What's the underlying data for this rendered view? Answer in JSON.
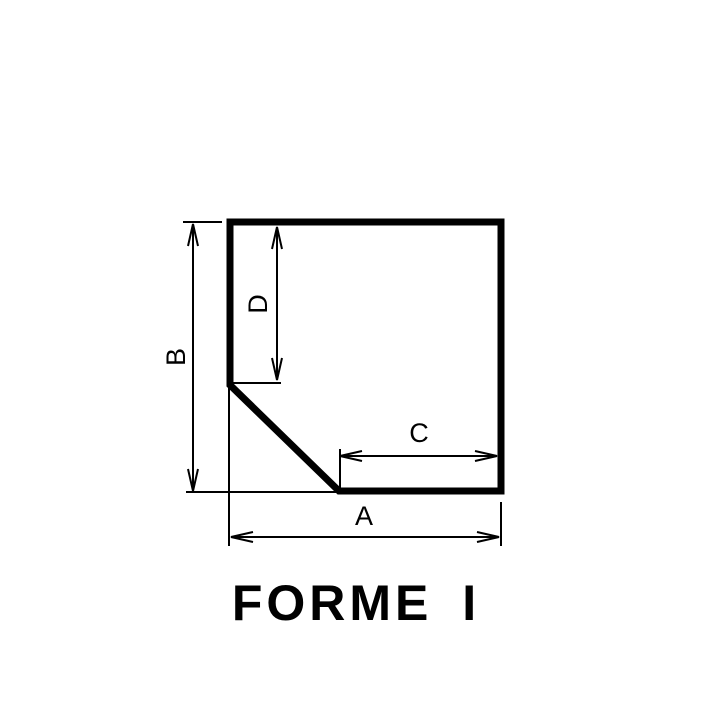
{
  "title": {
    "text": "FORME I"
  },
  "colors": {
    "ink": "#000000",
    "background": "#ffffff"
  },
  "shape": {
    "name": "chamfered-square",
    "points": "230,222 501,222 501,491 339,491 230,385",
    "stroke_width": 7
  },
  "dimension_labels": [
    "A",
    "B",
    "C",
    "D"
  ],
  "dimensions": [
    {
      "id": "B",
      "label": "B",
      "line": {
        "x1": 193,
        "y1": 224,
        "x2": 193,
        "y2": 491
      },
      "label_pos": {
        "x": 176,
        "y": 357,
        "rotate": -90
      },
      "extensions": [
        {
          "x1": 183,
          "y1": 222,
          "x2": 222,
          "y2": 222
        },
        {
          "x1": 186,
          "y1": 492,
          "x2": 341,
          "y2": 492
        }
      ]
    },
    {
      "id": "D",
      "label": "D",
      "line": {
        "x1": 277,
        "y1": 227,
        "x2": 277,
        "y2": 380
      },
      "label_pos": {
        "x": 258,
        "y": 304,
        "rotate": -90
      },
      "extensions": [
        {
          "x1": 233,
          "y1": 383,
          "x2": 281,
          "y2": 383
        }
      ]
    },
    {
      "id": "C",
      "label": "C",
      "line": {
        "x1": 340,
        "y1": 456,
        "x2": 497,
        "y2": 456
      },
      "label_pos": {
        "x": 419,
        "y": 433,
        "rotate": 0
      },
      "extensions": [
        {
          "x1": 340,
          "y1": 449,
          "x2": 340,
          "y2": 491
        }
      ]
    },
    {
      "id": "A",
      "label": "A",
      "line": {
        "x1": 231,
        "y1": 537,
        "x2": 499,
        "y2": 537
      },
      "label_pos": {
        "x": 364,
        "y": 516,
        "rotate": 0
      },
      "extensions": [
        {
          "x1": 229,
          "y1": 388,
          "x2": 229,
          "y2": 546
        },
        {
          "x1": 501,
          "y1": 502,
          "x2": 501,
          "y2": 546
        }
      ]
    }
  ],
  "style": {
    "dimension_stroke_width": 2,
    "extension_stroke_width": 2
  }
}
